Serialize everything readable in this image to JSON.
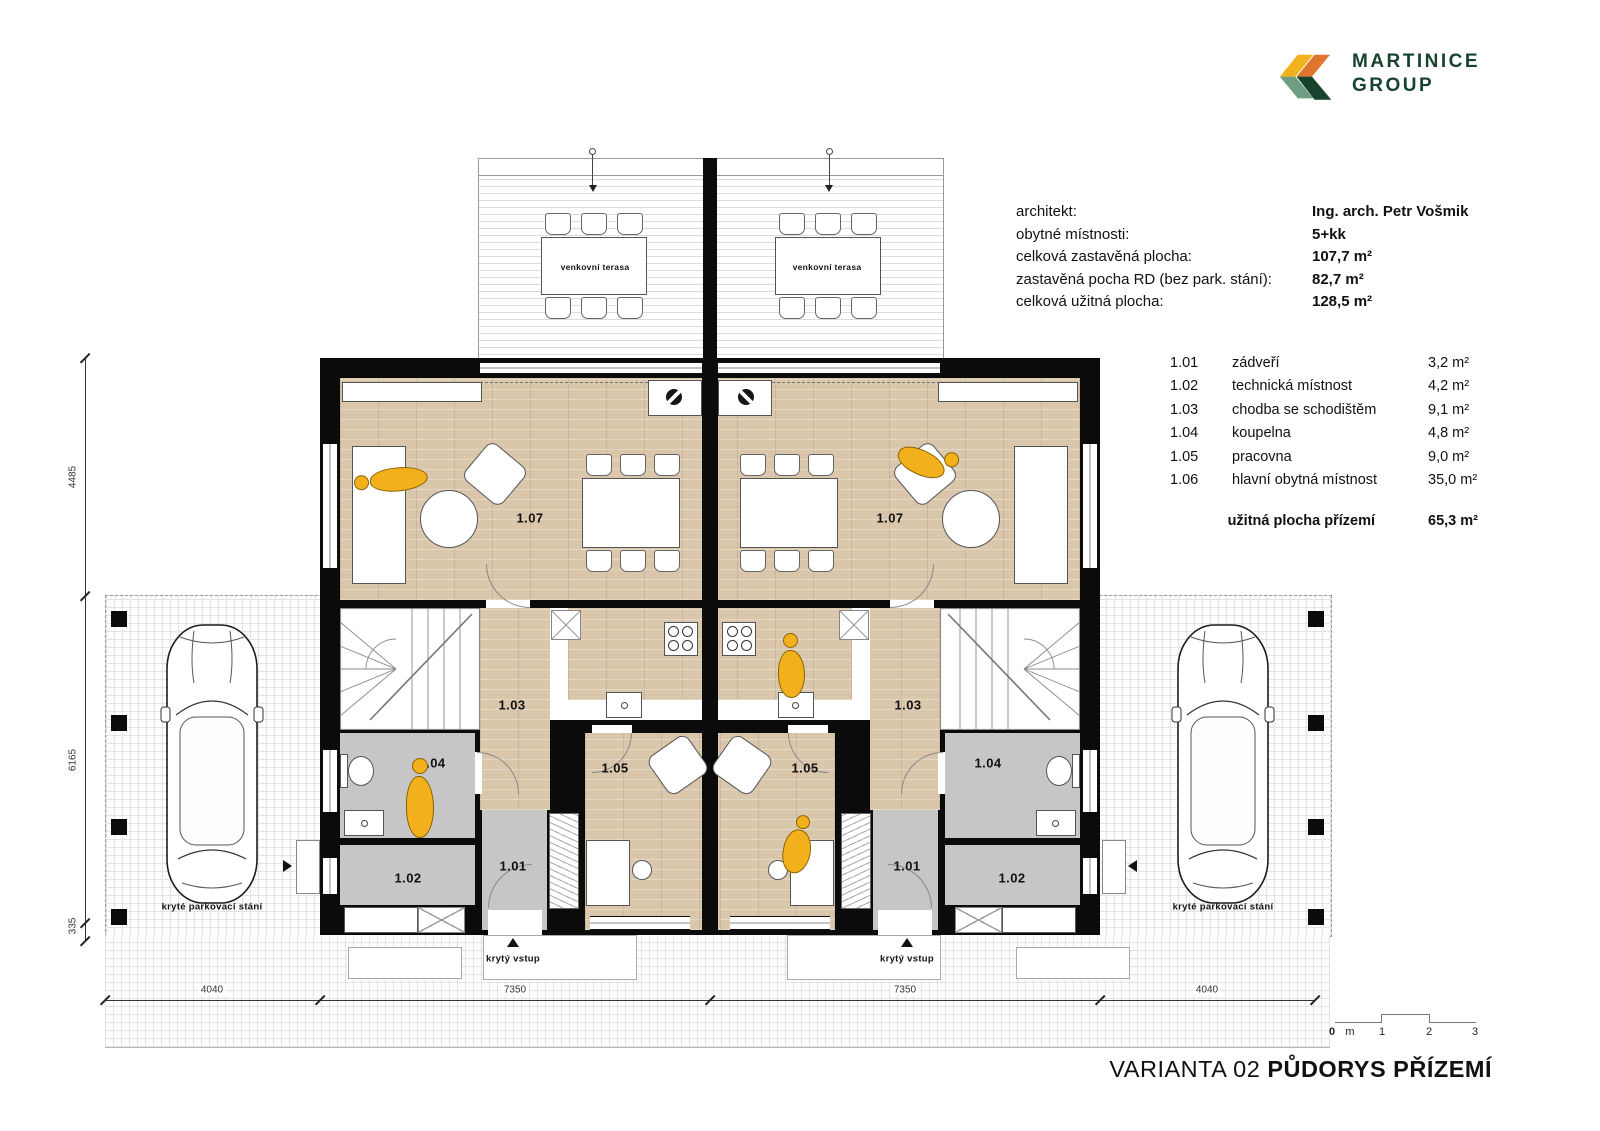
{
  "logo": {
    "line1": "MARTINICE",
    "line2": "GROUP"
  },
  "info": {
    "rows": [
      {
        "label": "architekt:",
        "value": "Ing. arch. Petr Vošmik"
      },
      {
        "label": "obytné místnosti:",
        "value": "5+kk"
      },
      {
        "label": "celková zastavěná plocha:",
        "value": "107,7 m²"
      },
      {
        "label": "zastavěná pocha RD (bez park. stání):",
        "value": "82,7 m²"
      },
      {
        "label": "celková užitná plocha:",
        "value": "128,5 m²"
      }
    ]
  },
  "legend": {
    "rows": [
      {
        "num": "1.01",
        "name": "zádveří",
        "area": "3,2 m²"
      },
      {
        "num": "1.02",
        "name": "technická místnost",
        "area": "4,2 m²"
      },
      {
        "num": "1.03",
        "name": "chodba se schodištěm",
        "area": "9,1 m²"
      },
      {
        "num": "1.04",
        "name": "koupelna",
        "area": "4,8 m²"
      },
      {
        "num": "1.05",
        "name": "pracovna",
        "area": "9,0 m²"
      },
      {
        "num": "1.06",
        "name": "hlavní obytná místnost",
        "area": "35,0 m²"
      }
    ],
    "total_label": "užitná plocha přízemí",
    "total_area": "65,3 m²"
  },
  "plan": {
    "terrace_label": "venkovní terasa",
    "entry_label": "krytý vstup",
    "parking_label": "kryté parkovací stání",
    "rooms": {
      "living": "1.07",
      "hall": "1.03",
      "bath": "1.04",
      "office": "1.05",
      "entry": "1.01",
      "tech": "1.02"
    },
    "dims": {
      "bottom": [
        "4040",
        "7350",
        "7350",
        "4040"
      ],
      "left": [
        "4485",
        "6165",
        "335"
      ]
    }
  },
  "scalebar": {
    "zero": "0",
    "unit": "m",
    "marks": [
      "1",
      "2",
      "3"
    ]
  },
  "title": {
    "variant": "VARIANTA 02",
    "name": "PŮDORYS PŘÍZEMÍ"
  },
  "colors": {
    "logo_yellow": "#F2B21E",
    "logo_orange": "#E2752E",
    "logo_green": "#6E9E82",
    "logo_dark_green": "#17432E",
    "wood_floor": "#D9C6AB",
    "gray_room": "#C6C6C6",
    "wall": "#0B0B0B",
    "person": "#F2B11C"
  }
}
